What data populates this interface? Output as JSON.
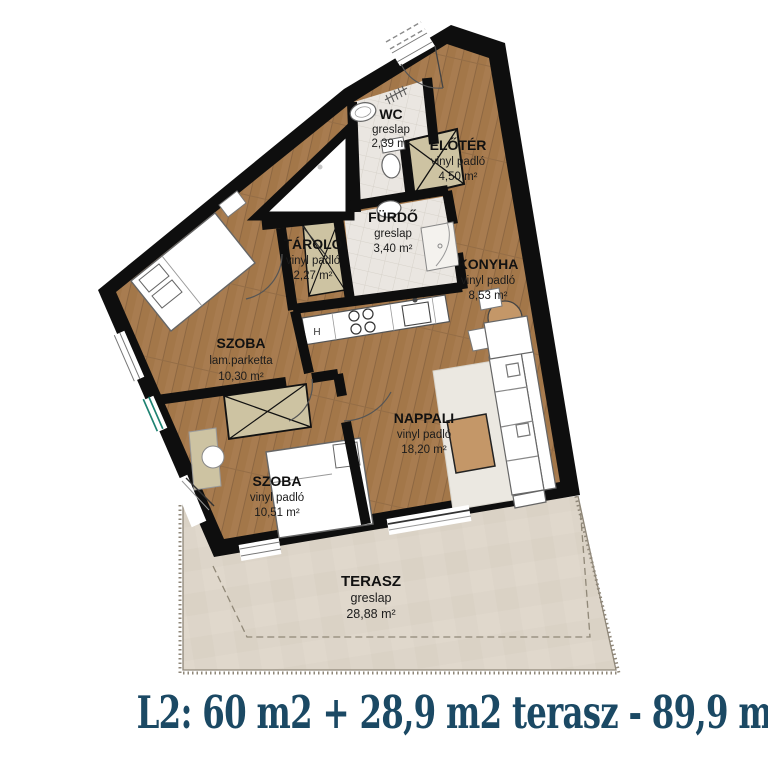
{
  "caption": "L2: 60 m2 + 28,9 m2 terasz - 89,9 millió",
  "plan": {
    "rooms": [
      {
        "id": "wc",
        "name": "WC",
        "floor": "greslap",
        "area": "2,39 m²"
      },
      {
        "id": "eloter",
        "name": "ELŐTÉR",
        "floor": "vinyl padló",
        "area": "4,50 m²"
      },
      {
        "id": "furdo",
        "name": "FÜRDŐ",
        "floor": "greslap",
        "area": "3,40 m²"
      },
      {
        "id": "tarolo",
        "name": "TÁROLÓ",
        "floor": "vinyl padló",
        "area": "2,27 m²"
      },
      {
        "id": "konyha",
        "name": "KONYHA",
        "floor": "vinyl padló",
        "area": "8,53 m²"
      },
      {
        "id": "szoba-1",
        "name": "SZOBA",
        "floor": "lam.parketta",
        "area": "10,30 m²"
      },
      {
        "id": "szoba-2",
        "name": "SZOBA",
        "floor": "vinyl padló",
        "area": "10,51 m²"
      },
      {
        "id": "nappali",
        "name": "NAPPALI",
        "floor": "vinyl padló",
        "area": "18,20 m²"
      },
      {
        "id": "terasz",
        "name": "TERASZ",
        "floor": "greslap",
        "area": "28,88 m²"
      }
    ],
    "kitchen_appliance_label": "H"
  },
  "colors": {
    "wall": "#0e0e0e",
    "wood_floor": "#a87c50",
    "tile_floor": "#eae6e1",
    "terrace": "#ddd5c9",
    "cabinet_beige": "#cdc3a2",
    "window_glass_teal": "#1e8272",
    "caption_text": "#1b4964"
  }
}
